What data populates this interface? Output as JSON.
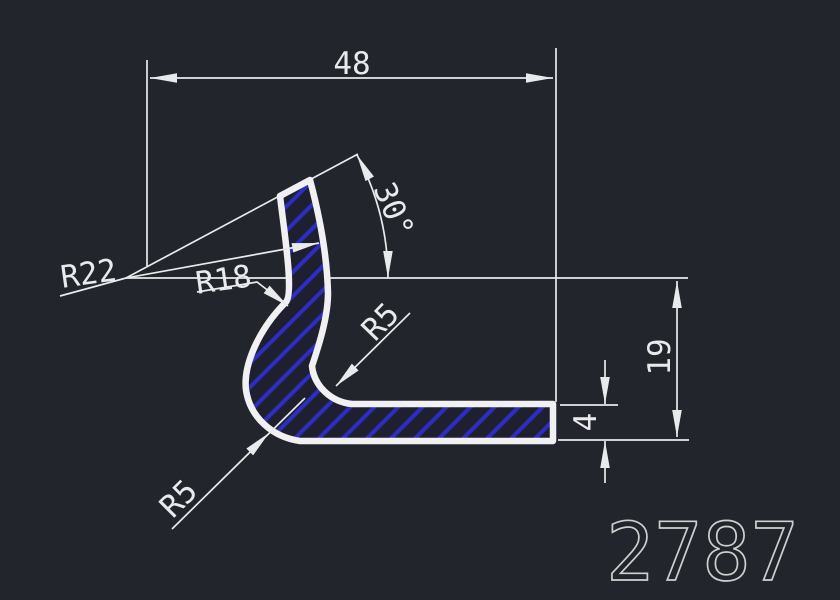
{
  "drawing": {
    "part_label": "2787",
    "dimensions": {
      "width": "48",
      "height": "19",
      "thickness": "4",
      "angle": "30°",
      "radius_outer": "R22",
      "radius_inner": "R18",
      "radius_fillet_top": "R5",
      "radius_fillet_bottom": "R5"
    }
  },
  "colors": {
    "background": "#22262c",
    "line": "#e9eaec",
    "profile_outline": "#f1f1f3",
    "profile_fill": "#1e2030",
    "hatch_line": "#2d2dc3",
    "part_label_color": "#cfcfcf"
  }
}
